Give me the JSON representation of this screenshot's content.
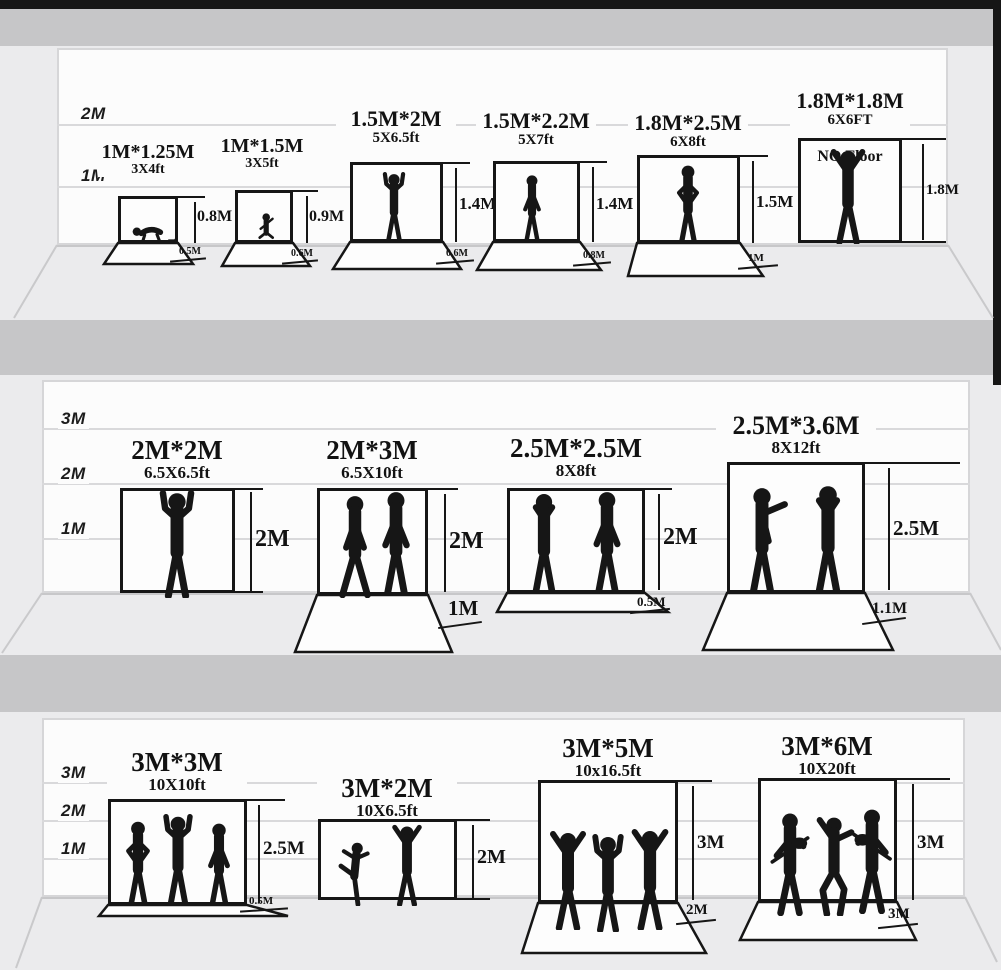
{
  "palette": {
    "ink": "#161616",
    "wall": "#fcfcfc",
    "floor": "#ebebed",
    "divider_band": "#c6c6c8",
    "wall_line": "#d9d9db"
  },
  "rows": [
    {
      "scale_labels": {
        "m2": "2M",
        "m1": "1M"
      },
      "items": [
        {
          "size": "1M*1.25M",
          "ft": "3X4ft",
          "height": "0.8M",
          "floor": "0.5M",
          "figure": "crawling-baby-with-toy"
        },
        {
          "size": "1M*1.5M",
          "ft": "3X5ft",
          "height": "0.9M",
          "floor": "0.6M",
          "figure": "sitting-toddler"
        },
        {
          "size": "1.5M*2M",
          "ft": "5X6.5ft",
          "height": "1.4M",
          "floor": "0.6M",
          "figure": "child-arms-raised"
        },
        {
          "size": "1.5M*2.2M",
          "ft": "5X7ft",
          "height": "1.4M",
          "floor": "0.8M",
          "figure": "standing-boy"
        },
        {
          "size": "1.8M*2.5M",
          "ft": "6X8ft",
          "height": "1.5M",
          "floor": "1M",
          "figure": "man-hands-on-hips"
        },
        {
          "size": "1.8M*1.8M",
          "ft": "6X6FT",
          "height": "1.8M",
          "note": "NO Floor",
          "figure": "man-arms-up"
        }
      ]
    },
    {
      "scale_labels": {
        "m3": "3M",
        "m2": "2M",
        "m1": "1M"
      },
      "items": [
        {
          "size": "2M*2M",
          "ft": "6.5X6.5ft",
          "height": "2M",
          "figure": "man-peace-signs"
        },
        {
          "size": "2M*3M",
          "ft": "6.5X10ft",
          "height": "2M",
          "floor": "1M",
          "figure": "two-men-standing"
        },
        {
          "size": "2.5M*2.5M",
          "ft": "8X8ft",
          "height": "2M",
          "floor": "0.5M",
          "figure": "two-men-talking"
        },
        {
          "size": "2.5M*3.6M",
          "ft": "8X12ft",
          "height": "2.5M",
          "floor": "1.1M",
          "figure": "two-businessmen"
        }
      ]
    },
    {
      "scale_labels": {
        "m3": "3M",
        "m2": "2M",
        "m1": "1M"
      },
      "items": [
        {
          "size": "3M*3M",
          "ft": "10X10ft",
          "height": "2.5M",
          "floor": "0.5M",
          "figure": "three-teens-standing"
        },
        {
          "size": "3M*2M",
          "ft": "10X6.5ft",
          "height": "2M",
          "figure": "two-breakdancers"
        },
        {
          "size": "3M*5M",
          "ft": "10x16.5ft",
          "height": "3M",
          "floor": "2M",
          "figure": "three-dancers"
        },
        {
          "size": "3M*6M",
          "ft": "10X20ft",
          "height": "3M",
          "floor": "3M",
          "figure": "rock-band-trio"
        }
      ]
    }
  ]
}
